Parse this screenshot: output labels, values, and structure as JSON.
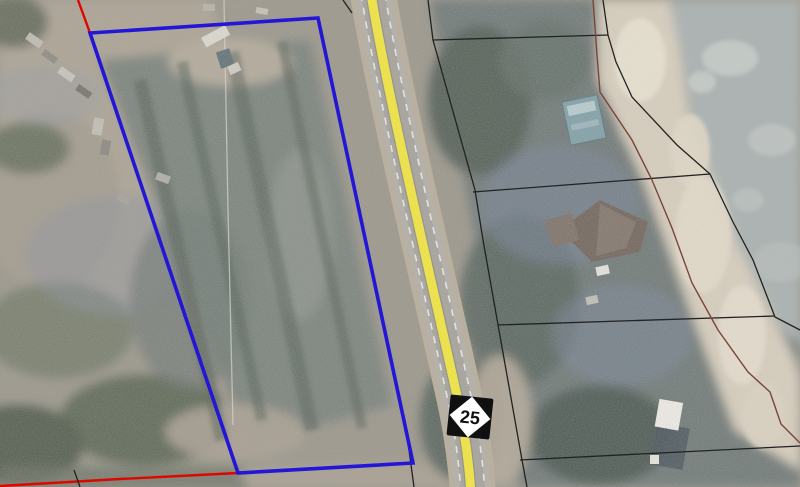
{
  "map": {
    "type": "aerial-parcel-map",
    "route_shield": {
      "number": "25"
    },
    "colors": {
      "selected_parcel_blue": "#2316d6",
      "boundary_red": "#df0600",
      "boundary_black": "#222222",
      "boundary_brown": "#7b4438",
      "road_centerline_yellow": "#f5e93a"
    },
    "selected_parcel": {
      "outline": [
        [
          90,
          33
        ],
        [
          318,
          18
        ],
        [
          413,
          463
        ],
        [
          238,
          473
        ]
      ],
      "color": "#2316d6",
      "width": 3.6
    },
    "boundary_lines": [
      {
        "id": "red-line-north",
        "color": "#df0600",
        "width": 2.4,
        "points": [
          [
            78,
            0
          ],
          [
            90,
            33
          ]
        ]
      },
      {
        "id": "red-line-south",
        "color": "#df0600",
        "width": 2.4,
        "points": [
          [
            0,
            486
          ],
          [
            120,
            479
          ],
          [
            238,
            473
          ]
        ]
      },
      {
        "id": "black-line-road-east",
        "color": "#222222",
        "width": 1.3,
        "points": [
          [
            428,
            0
          ],
          [
            433,
            40
          ],
          [
            475,
            190
          ],
          [
            483,
            240
          ],
          [
            522,
            460
          ],
          [
            527,
            487
          ]
        ]
      },
      {
        "id": "black-cross-line-north",
        "color": "#222222",
        "width": 1.3,
        "points": [
          [
            433,
            40
          ],
          [
            608,
            35
          ]
        ]
      },
      {
        "id": "black-line-northeast",
        "color": "#222222",
        "width": 1.3,
        "points": [
          [
            603,
            0
          ],
          [
            608,
            35
          ],
          [
            616,
            62
          ],
          [
            632,
            97
          ],
          [
            677,
            145
          ],
          [
            710,
            174
          ],
          [
            733,
            222
          ],
          [
            753,
            260
          ],
          [
            775,
            317
          ],
          [
            800,
            330
          ]
        ]
      },
      {
        "id": "black-cross-line-mid",
        "color": "#222222",
        "width": 1.3,
        "points": [
          [
            473,
            192
          ],
          [
            710,
            174
          ]
        ]
      },
      {
        "id": "black-cross-line-lower",
        "color": "#222222",
        "width": 1.3,
        "points": [
          [
            498,
            325
          ],
          [
            775,
            316
          ]
        ]
      },
      {
        "id": "black-cross-line-south",
        "color": "#222222",
        "width": 1.3,
        "points": [
          [
            520,
            460
          ],
          [
            800,
            446
          ]
        ]
      },
      {
        "id": "black-line-road-west-south",
        "color": "#222222",
        "width": 1.3,
        "points": [
          [
            406,
            428
          ],
          [
            414,
            487
          ]
        ]
      },
      {
        "id": "black-line-road-west-north",
        "color": "#222222",
        "width": 1.3,
        "points": [
          [
            343,
            0
          ],
          [
            352,
            13
          ]
        ]
      },
      {
        "id": "black-tick-south",
        "color": "#222222",
        "width": 1.3,
        "points": [
          [
            74,
            470
          ],
          [
            80,
            487
          ]
        ]
      },
      {
        "id": "brown-sand-edge-line",
        "color": "#7b4438",
        "width": 1.4,
        "points": [
          [
            593,
            0
          ],
          [
            597,
            55
          ],
          [
            600,
            92
          ],
          [
            632,
            140
          ],
          [
            652,
            180
          ],
          [
            672,
            228
          ],
          [
            692,
            283
          ],
          [
            718,
            330
          ],
          [
            748,
            372
          ],
          [
            770,
            392
          ],
          [
            781,
            424
          ],
          [
            800,
            443
          ]
        ]
      }
    ]
  }
}
